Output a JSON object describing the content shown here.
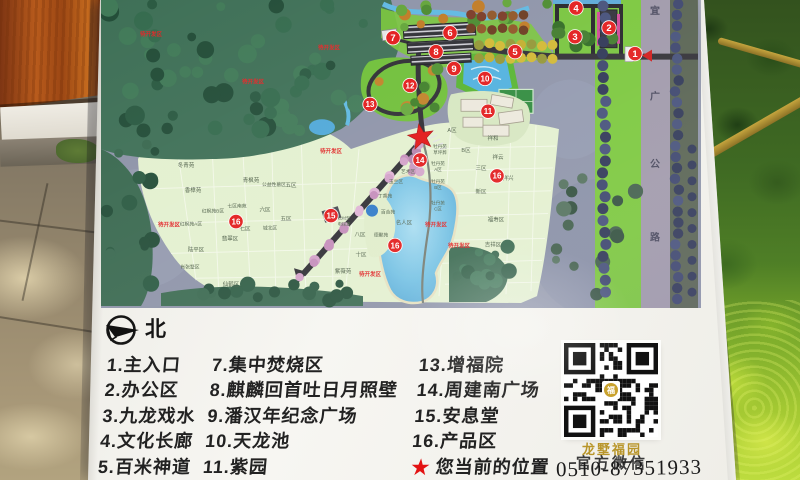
{
  "sign": {
    "compass_label": "北",
    "legend": {
      "columns": [
        {
          "items": [
            "1.主入口",
            "2.办公区",
            "3.九龙戏水",
            "4.文化长廊",
            "5.百米神道"
          ]
        },
        {
          "items": [
            "7.集中焚烧区",
            "8.麒麟回首吐日月照壁",
            "9.潘汉年纪念广场",
            "10.天龙池",
            "11.紫园"
          ]
        },
        {
          "items": [
            "13.增福院",
            "14.周建南广场",
            "15.安息堂",
            "16.产品区"
          ],
          "star_item": "您当前的位置"
        }
      ]
    },
    "qr": {
      "caption_line1": "龙墅福园",
      "caption_line2": "官方微信"
    },
    "phone": "0510-87351933"
  },
  "map": {
    "road_label": "宜广公路",
    "marker_color": "#e21b1b",
    "star_color": "#e21414",
    "star": {
      "x": 320,
      "y": 138
    },
    "markers": [
      {
        "n": "1",
        "x": 534,
        "y": 54
      },
      {
        "n": "2",
        "x": 508,
        "y": 28
      },
      {
        "n": "3",
        "x": 474,
        "y": 37
      },
      {
        "n": "4",
        "x": 475,
        "y": 8
      },
      {
        "n": "5",
        "x": 414,
        "y": 52
      },
      {
        "n": "6",
        "x": 349,
        "y": 33
      },
      {
        "n": "7",
        "x": 292,
        "y": 38
      },
      {
        "n": "8",
        "x": 335,
        "y": 52
      },
      {
        "n": "9",
        "x": 353,
        "y": 69
      },
      {
        "n": "10",
        "x": 384,
        "y": 79
      },
      {
        "n": "11",
        "x": 387,
        "y": 112
      },
      {
        "n": "12",
        "x": 309,
        "y": 86
      },
      {
        "n": "13",
        "x": 269,
        "y": 105
      },
      {
        "n": "14",
        "x": 319,
        "y": 161
      },
      {
        "n": "15",
        "x": 230,
        "y": 217
      },
      {
        "n": "16",
        "x": 135,
        "y": 223
      },
      {
        "n": "16",
        "x": 396,
        "y": 177
      },
      {
        "n": "16",
        "x": 294,
        "y": 247
      }
    ],
    "labels": [
      {
        "t": "待开发区",
        "x": 50,
        "y": 36,
        "c": "red"
      },
      {
        "t": "待开发区",
        "x": 228,
        "y": 50,
        "c": "red"
      },
      {
        "t": "待开发区",
        "x": 152,
        "y": 84,
        "c": "red"
      },
      {
        "t": "待开发区",
        "x": 230,
        "y": 154,
        "c": "red"
      },
      {
        "t": "待开发区",
        "x": 68,
        "y": 228,
        "c": "red"
      },
      {
        "t": "待开发区",
        "x": 335,
        "y": 228,
        "c": "red"
      },
      {
        "t": "待开发区",
        "x": 358,
        "y": 249,
        "c": "red"
      },
      {
        "t": "待开发区",
        "x": 269,
        "y": 278,
        "c": "red"
      },
      {
        "t": "冬青苑",
        "x": 85,
        "y": 168,
        "c": "plot"
      },
      {
        "t": "香樟苑",
        "x": 92,
        "y": 193,
        "c": "plot"
      },
      {
        "t": "青枫苑",
        "x": 150,
        "y": 183,
        "c": "plot"
      },
      {
        "t": "公益性墓区",
        "x": 173,
        "y": 187,
        "c": "plot",
        "s": 4.8
      },
      {
        "t": "五区",
        "x": 190,
        "y": 188,
        "c": "plot"
      },
      {
        "t": "五区",
        "x": 185,
        "y": 222,
        "c": "plot"
      },
      {
        "t": "六区",
        "x": 164,
        "y": 213,
        "c": "plot"
      },
      {
        "t": "七区南苑",
        "x": 136,
        "y": 209,
        "c": "plot",
        "s": 4.8
      },
      {
        "t": "红枫苑B区",
        "x": 112,
        "y": 214,
        "c": "plot",
        "s": 4.8
      },
      {
        "t": "红枫苑A区",
        "x": 90,
        "y": 227,
        "c": "plot",
        "s": 4.8
      },
      {
        "t": "七区",
        "x": 144,
        "y": 232,
        "c": "plot"
      },
      {
        "t": "城北区",
        "x": 169,
        "y": 231,
        "c": "plot",
        "s": 4.8
      },
      {
        "t": "翡翠区",
        "x": 129,
        "y": 242,
        "c": "plot"
      },
      {
        "t": "陆平区",
        "x": 95,
        "y": 253,
        "c": "plot"
      },
      {
        "t": "肖张墅区",
        "x": 89,
        "y": 270,
        "c": "plot",
        "s": 4.8
      },
      {
        "t": "仙鹤区",
        "x": 130,
        "y": 288,
        "c": "plot"
      },
      {
        "t": "松村型",
        "x": 243,
        "y": 221,
        "c": "plot",
        "s": 4.2
      },
      {
        "t": "电梯墓",
        "x": 243,
        "y": 227,
        "c": "plot",
        "s": 4.2
      },
      {
        "t": "A区",
        "x": 351,
        "y": 133,
        "c": "plot"
      },
      {
        "t": "B区",
        "x": 365,
        "y": 153,
        "c": "plot"
      },
      {
        "t": "三区",
        "x": 380,
        "y": 171,
        "c": "plot"
      },
      {
        "t": "新区",
        "x": 380,
        "y": 195,
        "c": "plot"
      },
      {
        "t": "祥和",
        "x": 392,
        "y": 141,
        "c": "plot"
      },
      {
        "t": "祥云",
        "x": 397,
        "y": 160,
        "c": "plot"
      },
      {
        "t": "祥兴",
        "x": 407,
        "y": 181,
        "c": "plot"
      },
      {
        "t": "福寿区",
        "x": 395,
        "y": 223,
        "c": "plot"
      },
      {
        "t": "吉祥区",
        "x": 392,
        "y": 248,
        "c": "plot"
      },
      {
        "t": "牡丹苑",
        "x": 339,
        "y": 149,
        "c": "plot",
        "s": 4.5
      },
      {
        "t": "草坪葬",
        "x": 339,
        "y": 155,
        "c": "plot",
        "s": 4.5
      },
      {
        "t": "牡丹苑",
        "x": 337,
        "y": 166,
        "c": "plot",
        "s": 4.5
      },
      {
        "t": "A区",
        "x": 337,
        "y": 172,
        "c": "plot",
        "s": 4.5
      },
      {
        "t": "牡丹苑",
        "x": 337,
        "y": 184,
        "c": "plot",
        "s": 4.5
      },
      {
        "t": "B区",
        "x": 337,
        "y": 190,
        "c": "plot",
        "s": 4.5
      },
      {
        "t": "牡丹苑",
        "x": 337,
        "y": 206,
        "c": "plot",
        "s": 4.5
      },
      {
        "t": "C区",
        "x": 337,
        "y": 212,
        "c": "plot",
        "s": 4.5
      },
      {
        "t": "名人区",
        "x": 303,
        "y": 226,
        "c": "plot"
      },
      {
        "t": "八区",
        "x": 259,
        "y": 238,
        "c": "plot"
      },
      {
        "t": "十区",
        "x": 260,
        "y": 258,
        "c": "plot"
      },
      {
        "t": "紫薇苑",
        "x": 242,
        "y": 275,
        "c": "plot"
      },
      {
        "t": "德聚苑",
        "x": 280,
        "y": 238,
        "c": "plot",
        "s": 4.8
      },
      {
        "t": "百合苑",
        "x": 287,
        "y": 215,
        "c": "plot",
        "s": 4.8
      },
      {
        "t": "丁香苑",
        "x": 284,
        "y": 199,
        "c": "plot",
        "s": 4.8
      },
      {
        "t": "玉兰区",
        "x": 295,
        "y": 184,
        "c": "plot",
        "s": 4.8
      },
      {
        "t": "艺术区",
        "x": 307,
        "y": 174,
        "c": "plot",
        "s": 4.8
      }
    ]
  }
}
